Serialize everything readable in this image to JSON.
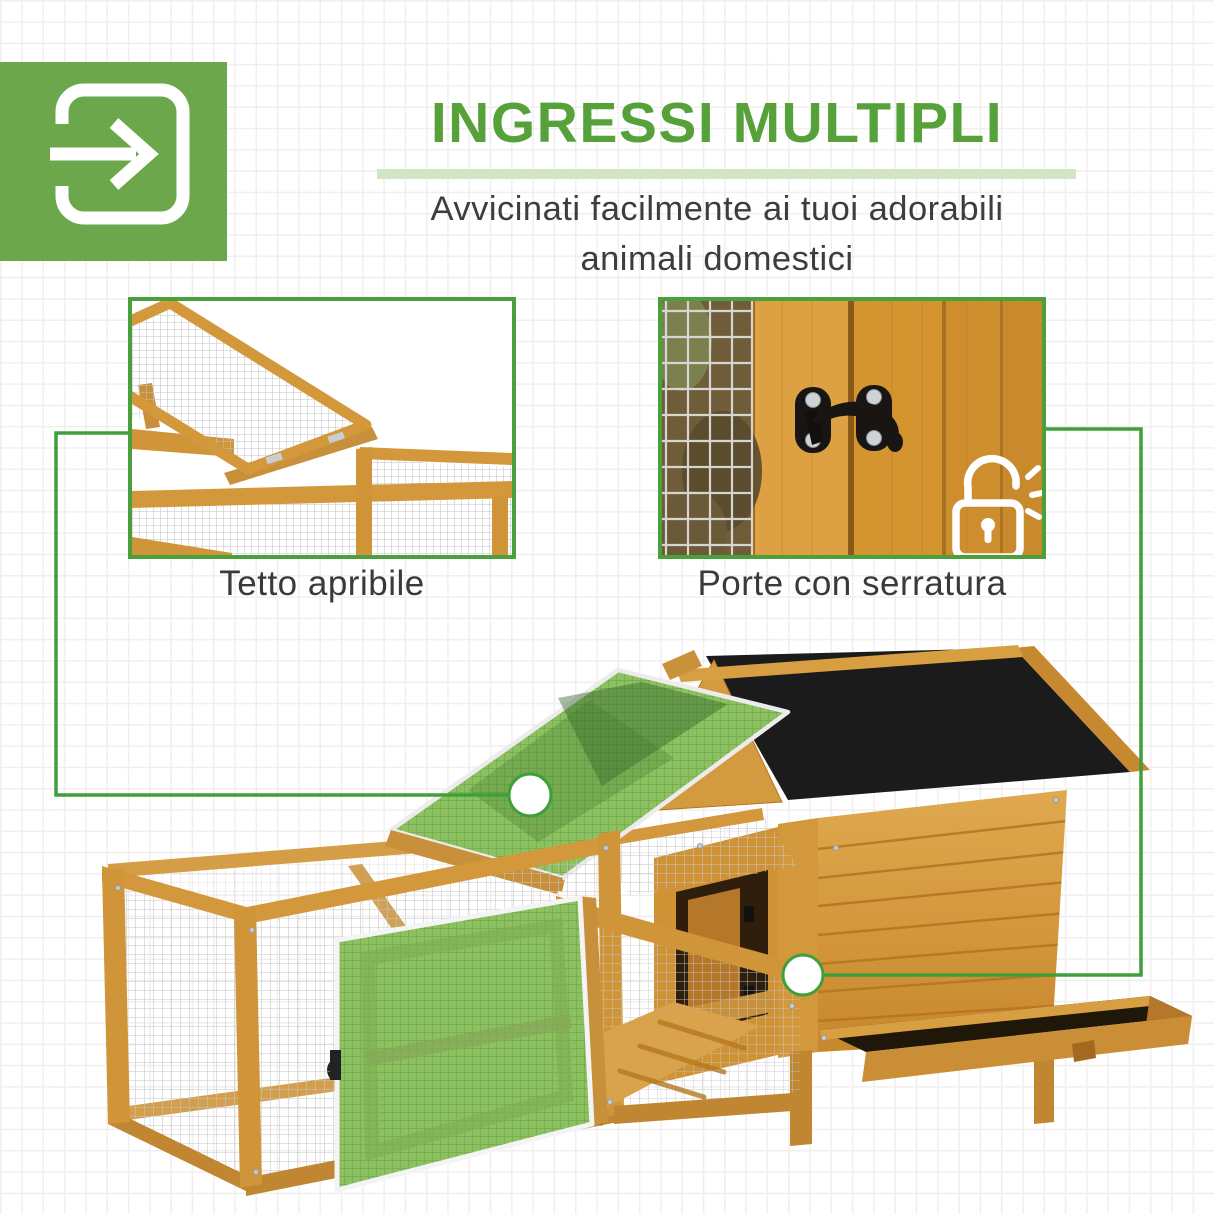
{
  "header": {
    "title": "INGRESSI MULTIPLI",
    "subtitle_line1": "Avvicinati facilmente ai tuoi adorabili",
    "subtitle_line2": "animali domestici"
  },
  "features": [
    {
      "id": "roof",
      "caption": "Tetto apribile"
    },
    {
      "id": "doors",
      "caption": "Porte con serratura"
    }
  ],
  "icons": {
    "header_icon": "login-arrow-icon",
    "lock_icon": "unlocked-padlock-icon"
  },
  "colors": {
    "brand_green": "#6ca84b",
    "title_green": "#57a13a",
    "underline_green": "#d2e5c4",
    "line_green": "#3f9f3a",
    "border_green": "#4aa03c",
    "text_dark": "#3d3d3d",
    "grid_line": "#f1eeee",
    "wood_light": "#e2aa52",
    "wood_mid": "#d3983b",
    "wood_dark": "#b5741f",
    "roof_black": "#1b1b1b",
    "mesh_green": "#8cc161",
    "tray_dark": "#1f1708"
  }
}
